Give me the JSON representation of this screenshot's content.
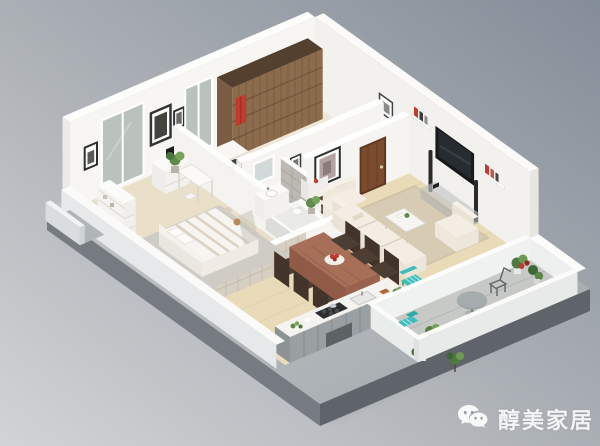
{
  "watermark": {
    "icon": "wechat-icon",
    "label": "醇美家居",
    "text_color": "#ffffff"
  },
  "scene": {
    "type": "3d-apartment-floor-plan-render",
    "rooms": [
      "master-bedroom",
      "second-bedroom",
      "bathroom",
      "hallway",
      "living-room",
      "dining-area",
      "kitchen",
      "balcony"
    ]
  },
  "palette": {
    "background_top": "#8a929e",
    "background_bottom": "#d0d1d3",
    "platform_side": "#6a7075",
    "wall_white": "#f7f6f3",
    "floor_wood": "#e9dab8",
    "floor_bedroom": "#eadfc9",
    "rug_gray": "#cfccc6",
    "rug_beige": "#d8cbb4",
    "sofa_cream": "#f3ede3",
    "dining_table_wood": "#a86f58",
    "chair_dark": "#4d3e33",
    "closet_wood": "#8d6c4d",
    "door_brown": "#7b4b2e",
    "accent_teal": "#3fbdbd",
    "accent_red": "#c23b30",
    "tv_screen": "#17191b",
    "counter_gray": "#9aa0a2",
    "glass": "#b5bfb9",
    "balcony_floor": "#c6c9c6",
    "plant_green": "#5f8a4a"
  }
}
